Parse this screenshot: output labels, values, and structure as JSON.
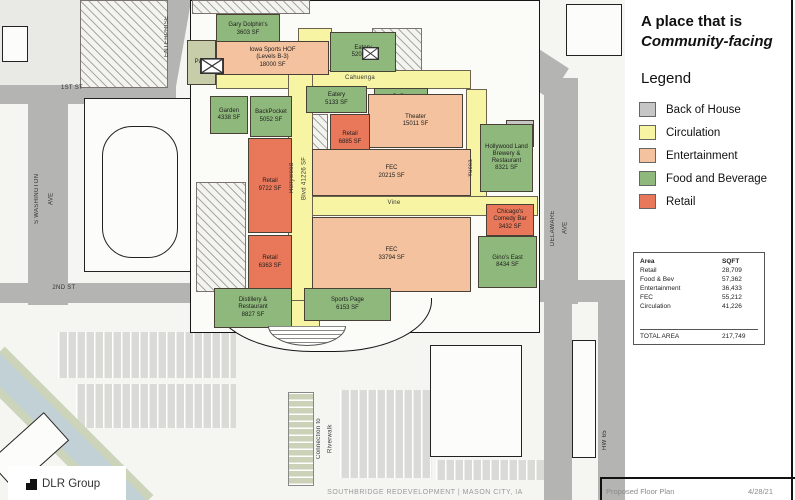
{
  "panel": {
    "title_line1": "A place that is",
    "title_line2": "Community-facing",
    "legend_title": "Legend",
    "legend": [
      {
        "label": "Back of House",
        "color": "#c6c6c6"
      },
      {
        "label": "Circulation",
        "color": "#f7f5a3"
      },
      {
        "label": "Entertainment",
        "color": "#f4c29e"
      },
      {
        "label": "Food and Beverage",
        "color": "#8fb97c"
      },
      {
        "label": "Retail",
        "color": "#e9785a"
      }
    ],
    "table": {
      "header": {
        "area": "Area",
        "sqft": "SQFT"
      },
      "rows": [
        {
          "area": "Retail",
          "sqft": "28,709"
        },
        {
          "area": "Food & Bev",
          "sqft": "57,362"
        },
        {
          "area": "Entertainment",
          "sqft": "36,433"
        },
        {
          "area": "FEC",
          "sqft": "55,212"
        },
        {
          "area": "Circulation",
          "sqft": "41,226"
        }
      ],
      "total_label": "TOTAL AREA",
      "total_value": "217,749"
    }
  },
  "footer": {
    "logo": "DLR Group",
    "project": "SOUTHBRIDGE REDEVELOPMENT | MASON CITY, IA",
    "sheet": "Proposed Floor Plan",
    "date": "4/28/21"
  },
  "map": {
    "blocks": [
      {
        "id": "gary-dolphins",
        "name": "Gary Dolphin's",
        "sqft": "3603 SF",
        "cat": "food",
        "x": 216,
        "y": 14,
        "w": 64,
        "h": 31
      },
      {
        "id": "patio",
        "name": "Patio",
        "sqft": "",
        "cat": "patio",
        "x": 187,
        "y": 40,
        "w": 29,
        "h": 45
      },
      {
        "id": "iowa-sports-hof",
        "name": "Iowa Sports HOF\n(Levels B-3)",
        "sqft": "18000 SF",
        "cat": "ent",
        "x": 216,
        "y": 41,
        "w": 113,
        "h": 34
      },
      {
        "id": "eatery-5203",
        "name": "Eatery",
        "sqft": "5203 SF",
        "cat": "food",
        "x": 330,
        "y": 32,
        "w": 66,
        "h": 40
      },
      {
        "id": "garden",
        "name": "Garden",
        "sqft": "4338 SF",
        "cat": "food",
        "x": 210,
        "y": 96,
        "w": 38,
        "h": 38
      },
      {
        "id": "backpocket",
        "name": "BackPocket",
        "sqft": "5052 SF",
        "cat": "food",
        "x": 250,
        "y": 96,
        "w": 42,
        "h": 41
      },
      {
        "id": "eatery-5133",
        "name": "Eatery",
        "sqft": "5133 SF",
        "cat": "food",
        "x": 306,
        "y": 86,
        "w": 61,
        "h": 27
      },
      {
        "id": "coffee",
        "name": "Coffee",
        "sqft": "2266 SF",
        "cat": "food",
        "x": 374,
        "y": 88,
        "w": 54,
        "h": 27
      },
      {
        "id": "theater",
        "name": "Theater",
        "sqft": "15011 SF",
        "cat": "ent",
        "x": 368,
        "y": 94,
        "w": 95,
        "h": 54
      },
      {
        "id": "retail-6885",
        "name": "Retail",
        "sqft": "6885 SF",
        "cat": "retail",
        "x": 330,
        "y": 114,
        "w": 40,
        "h": 49
      },
      {
        "id": "retail-9722",
        "name": "Retail",
        "sqft": "9722 SF",
        "cat": "retail",
        "x": 248,
        "y": 138,
        "w": 44,
        "h": 95
      },
      {
        "id": "fec-20215",
        "name": "FEC",
        "sqft": "20215 SF",
        "cat": "ent",
        "x": 312,
        "y": 149,
        "w": 159,
        "h": 47
      },
      {
        "id": "dock",
        "name": "Dock",
        "sqft": "1800 SF",
        "cat": "boh",
        "x": 506,
        "y": 120,
        "w": 28,
        "h": 27
      },
      {
        "id": "hollywood-land-brewery",
        "name": "Hollywood Land\nBrewery &\nRestaurant",
        "sqft": "8321 SF",
        "cat": "food",
        "x": 480,
        "y": 124,
        "w": 53,
        "h": 68
      },
      {
        "id": "chicagos-comedy-bar",
        "name": "Chicago's\nComedy Bar",
        "sqft": "3432 SF",
        "cat": "retail",
        "x": 486,
        "y": 204,
        "w": 48,
        "h": 32
      },
      {
        "id": "fec-33794",
        "name": "FEC",
        "sqft": "33794 SF",
        "cat": "ent",
        "x": 312,
        "y": 217,
        "w": 159,
        "h": 75
      },
      {
        "id": "ginos-east",
        "name": "Gino's East",
        "sqft": "8434 SF",
        "cat": "food",
        "x": 478,
        "y": 236,
        "w": 59,
        "h": 52
      },
      {
        "id": "retail-6363",
        "name": "Retail",
        "sqft": "6363 SF",
        "cat": "retail",
        "x": 248,
        "y": 235,
        "w": 44,
        "h": 55
      },
      {
        "id": "distillery-restaurant",
        "name": "Distillery &\nRestaurant",
        "sqft": "8827 SF",
        "cat": "food",
        "x": 214,
        "y": 288,
        "w": 78,
        "h": 40
      },
      {
        "id": "sports-page",
        "name": "Sports Page",
        "sqft": "6153 SF",
        "cat": "food",
        "x": 304,
        "y": 288,
        "w": 87,
        "h": 33
      }
    ],
    "labels": [
      {
        "id": "street-1st-st",
        "text": "1ST ST",
        "x": 50,
        "y": 84,
        "w": 44,
        "h": 10
      },
      {
        "id": "street-s-washington-ave",
        "text": "S WASHINGTON\nAVE",
        "x": 30,
        "y": 156,
        "w": 32,
        "h": 86,
        "vertical": true
      },
      {
        "id": "street-2nd-st",
        "text": "2ND ST",
        "x": 42,
        "y": 284,
        "w": 44,
        "h": 10
      },
      {
        "id": "street-enterprise",
        "text": "ENTERPRISE",
        "x": 163,
        "y": 4,
        "w": 22,
        "h": 64,
        "vertical": true
      },
      {
        "id": "street-delaware-ave",
        "text": "DELAWARE\nAVE",
        "x": 547,
        "y": 188,
        "w": 28,
        "h": 80,
        "vertical": true
      },
      {
        "id": "street-hw-65",
        "text": "HW 65",
        "x": 601,
        "y": 416,
        "w": 18,
        "h": 48,
        "vertical": true
      },
      {
        "id": "corridor-cahuenga",
        "text": "Cahuenga",
        "x": 322,
        "y": 73,
        "w": 76,
        "h": 12
      },
      {
        "id": "corridor-vine",
        "text": "Vine",
        "x": 374,
        "y": 198,
        "w": 40,
        "h": 12
      },
      {
        "id": "corridor-hollywood-blvd",
        "text": "Hollywood\nBlvd  41226 SF",
        "x": 286,
        "y": 140,
        "w": 28,
        "h": 76,
        "vertical": true
      },
      {
        "id": "corridor-yucca",
        "text": "Yucca",
        "x": 467,
        "y": 148,
        "w": 18,
        "h": 40,
        "vertical": true
      },
      {
        "id": "connection-to-riverwalk",
        "text": "Connection to\nRiverwalk",
        "x": 314,
        "y": 398,
        "w": 26,
        "h": 82,
        "vertical": true
      }
    ]
  }
}
